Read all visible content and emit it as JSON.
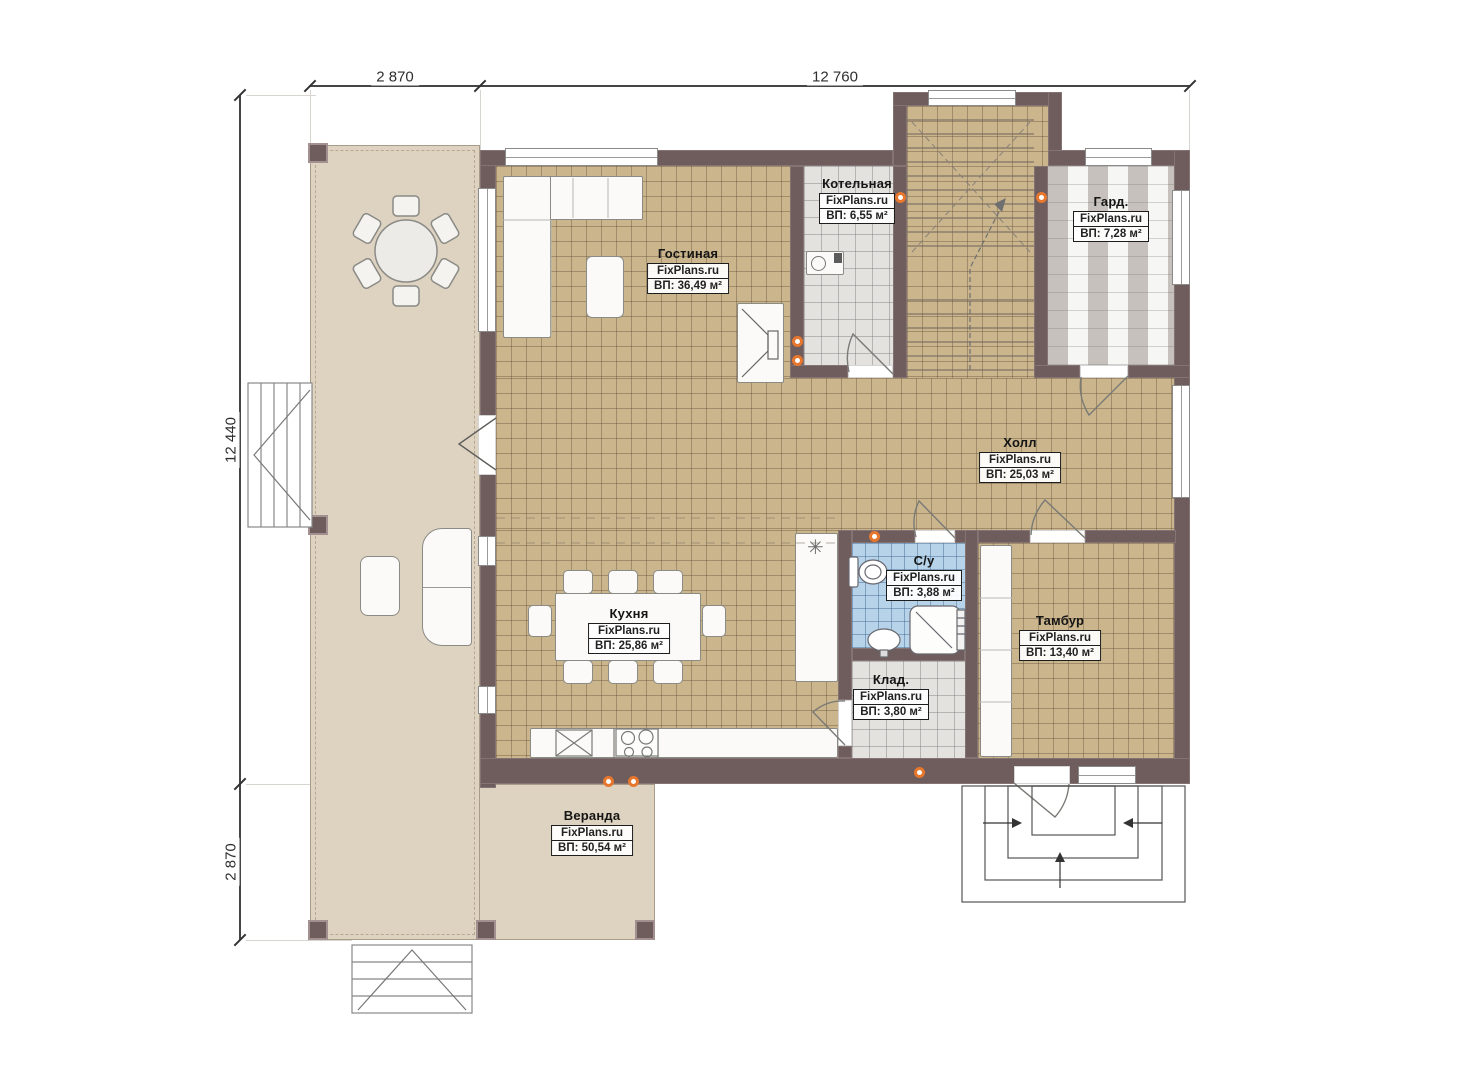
{
  "brand": "FixPlans.ru",
  "dimensions": {
    "top": [
      "2 870",
      "12 760"
    ],
    "left": [
      "12 440",
      "2 870"
    ]
  },
  "rooms": [
    {
      "id": "gostinaya",
      "name": "Гостиная",
      "area": "ВП: 36,49 м²"
    },
    {
      "id": "kotelnaya",
      "name": "Котельная",
      "area": "ВП: 6,55 м²"
    },
    {
      "id": "gard",
      "name": "Гард.",
      "area": "ВП: 7,28 м²"
    },
    {
      "id": "holl",
      "name": "Холл",
      "area": "ВП: 25,03 м²"
    },
    {
      "id": "kuhnya",
      "name": "Кухня",
      "area": "ВП: 25,86 м²"
    },
    {
      "id": "su",
      "name": "С/у",
      "area": "ВП: 3,88 м²"
    },
    {
      "id": "tambur",
      "name": "Тамбур",
      "area": "ВП: 13,40 м²"
    },
    {
      "id": "klad",
      "name": "Клад.",
      "area": "ВП: 3,80 м²"
    },
    {
      "id": "veranda",
      "name": "Веранда",
      "area": "ВП: 50,54 м²"
    }
  ],
  "symbols": {
    "drain": "✳"
  },
  "colors": {
    "wall": "#6f5c5c",
    "floor_tan": "#cab58c",
    "floor_gray": "#e4e2df",
    "floor_blue": "#b6d3e9",
    "veranda": "#ded2c0",
    "socket": "#e8772e"
  }
}
